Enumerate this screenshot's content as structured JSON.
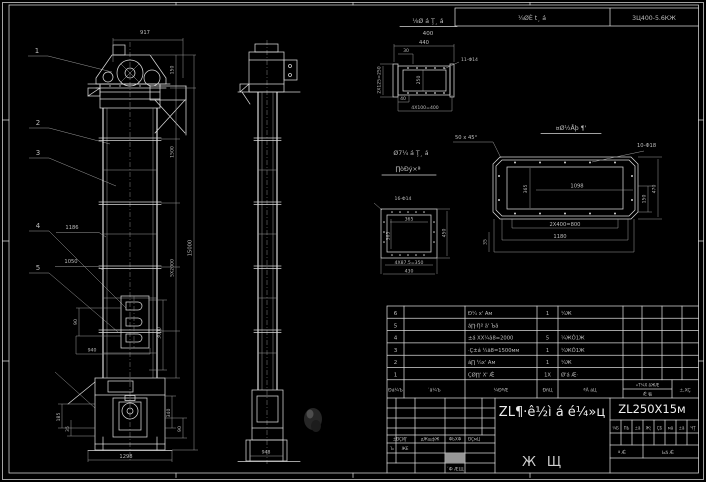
{
  "top": {
    "detail_title": "⅛Ø á Ţ¸ á",
    "detail_sub": "400",
    "cell_mid": "¼ØÈ t¸ á",
    "cell_right": "3Ц400-5.6КЖ"
  },
  "balloons": {
    "b1": "1",
    "b2": "2",
    "b3": "3",
    "b4": "4",
    "b5": "5"
  },
  "front": {
    "d917": "917",
    "d150": "150",
    "d1500": "1500",
    "d5x2000": "5Х2000",
    "d3000": "3000",
    "d15000": "15000",
    "d1186": "1186",
    "d1050": "1050",
    "win90": "90",
    "d940": "940",
    "dl185": "185",
    "dl35": "35",
    "dr340": "340",
    "br90": "90",
    "d1298": "1298"
  },
  "side": {
    "d948": "948"
  },
  "dtop": {
    "d440": "440",
    "d30": "30",
    "d2x125": "2Х125=250",
    "d250": "250",
    "d40": "40",
    "d4x100": "4Х100=400",
    "holes": "11-Φ14"
  },
  "dmid": {
    "t1": "Ø7¼ á Ţ¸ á",
    "t2": "∏òÐý×ª",
    "holes": "16-Φ14",
    "d365a": "365",
    "d365b": "365",
    "d450": "450",
    "d4x87": "4Х87.5=350",
    "d430": "430"
  },
  "dright": {
    "title": "¤Ø½Åþ ¶'",
    "note": "50 x 45°",
    "holes": "10-Φ18",
    "d1098": "1098",
    "d365": "365",
    "d150": "150",
    "d470": "470",
    "d2x400": "2Х400=800",
    "d1180": "1180",
    "d35": "35"
  },
  "bom": {
    "header": {
      "no": "Ðá¼Ъ",
      "code": "´ã¼Ъ",
      "name": "¼ÐªÆ",
      "qty": "ÐñЦ",
      "mat": "ªÃ áЦ",
      "weight": "«Т¼Х ãЖÆ",
      "weight_sub": "Ǽ 㸸",
      "remark": "±,XÇ"
    },
    "rows": [
      {
        "no": "6",
        "name": "Ð¼ х' Ам",
        "qty": "1",
        "mat": "¼Ж"
      },
      {
        "no": "5",
        "name": "á∏·Ŋª ã' Ъã",
        "qty": "",
        "mat": ""
      },
      {
        "no": "4",
        "name": "±á XX¼ã8=2000",
        "qty": "5",
        "mat": "¼ЖÔ1Ж"
      },
      {
        "no": "3",
        "name": "·Ç±á ¼ã8=1500мм",
        "qty": "1",
        "mat": "¼ЖÔ1Ж"
      },
      {
        "no": "2",
        "name": "á∏ ¼х' Ам",
        "qty": "1",
        "mat": "¼Ж"
      },
      {
        "no": "1",
        "name": "ÇØ∏' X' Ǽ",
        "qty": "1X",
        "mat": "Ø'á Æ·"
      }
    ]
  },
  "tb": {
    "title": "ZL¶·ê½ì á é¼»ц",
    "no": "ZL250X15м",
    "cells": [
      "¼Б",
      "ПЬ",
      "±ã",
      "Ж¦",
      "ÇБ",
      "мã",
      "±ã",
      "ЧŢ"
    ],
    "approve1": "ª Ǽ",
    "approve2": "Ьã Ǽ",
    "g1": "Ж",
    "g2": "Щ",
    "lh1": "±ÐÇИЈ'",
    "lh2": "дЖщфЖ",
    "lh3": "ФЬХФ",
    "lh4": "ÐÇмЦ",
    "lr1": "´Ь",
    "lr2": "ЖЕ",
    "lb1": "´Ф ÆЩ"
  }
}
